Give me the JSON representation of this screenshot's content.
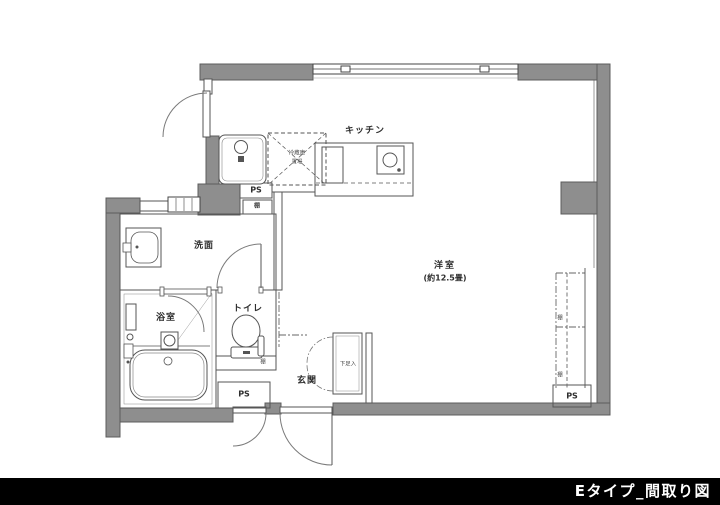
{
  "caption": "Eタイプ_間取り図",
  "colors": {
    "wall_fill": "#8e8e8e",
    "wall_edge": "#5c5c5c",
    "line": "#4d4d4d",
    "text": "#2e2e2e",
    "caption_bg": "#000000",
    "caption_text": "#ffffff"
  },
  "rooms": {
    "kitchen": "キッチン",
    "main_room": "洋室",
    "main_room_size": "(約12.5畳)",
    "washroom": "洗面",
    "bathroom": "浴室",
    "toilet": "トイレ",
    "entrance": "玄関"
  },
  "fixtures": {
    "fridge_line1": "冷蔵庫",
    "fridge_line2": "置場",
    "shoe_cabinet": "下足入"
  },
  "labels": {
    "ps": "PS",
    "shelf": "棚"
  }
}
